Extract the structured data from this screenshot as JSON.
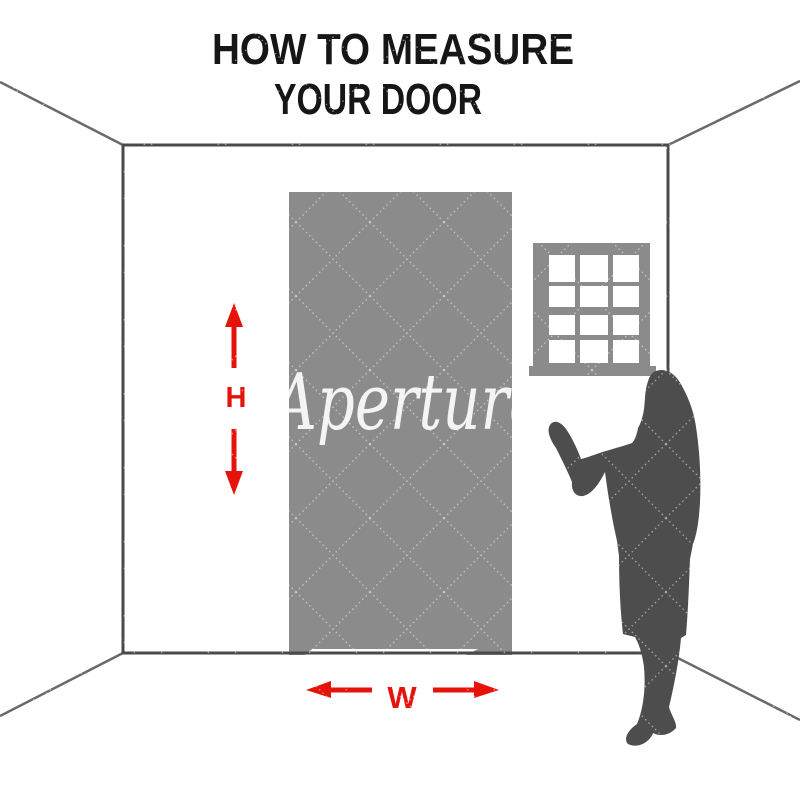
{
  "title": {
    "line1": "HOW TO MEASURE",
    "line2": "YOUR DOOR"
  },
  "measurements": {
    "height_label": "H",
    "width_label": "W"
  },
  "watermark": {
    "text": "Aperture"
  },
  "window": {
    "pane_columns": 3,
    "pane_rows": 4
  },
  "icons": {
    "up_arrow": "red-triangle-up",
    "down_arrow": "red-triangle-down",
    "left_arrow": "red-triangle-left",
    "right_arrow": "red-triangle-right"
  },
  "colors": {
    "accent_red": "#e6130b",
    "door_gray": "#8b8b8b",
    "window_gray": "#8b8b8b",
    "figure_gray": "#4d4d4d",
    "wall_line": "#4a4a4a",
    "perspective_line": "#6a6a6a",
    "title_text": "#161616",
    "watermark_white": "#ffffff",
    "background": "#ffffff"
  }
}
